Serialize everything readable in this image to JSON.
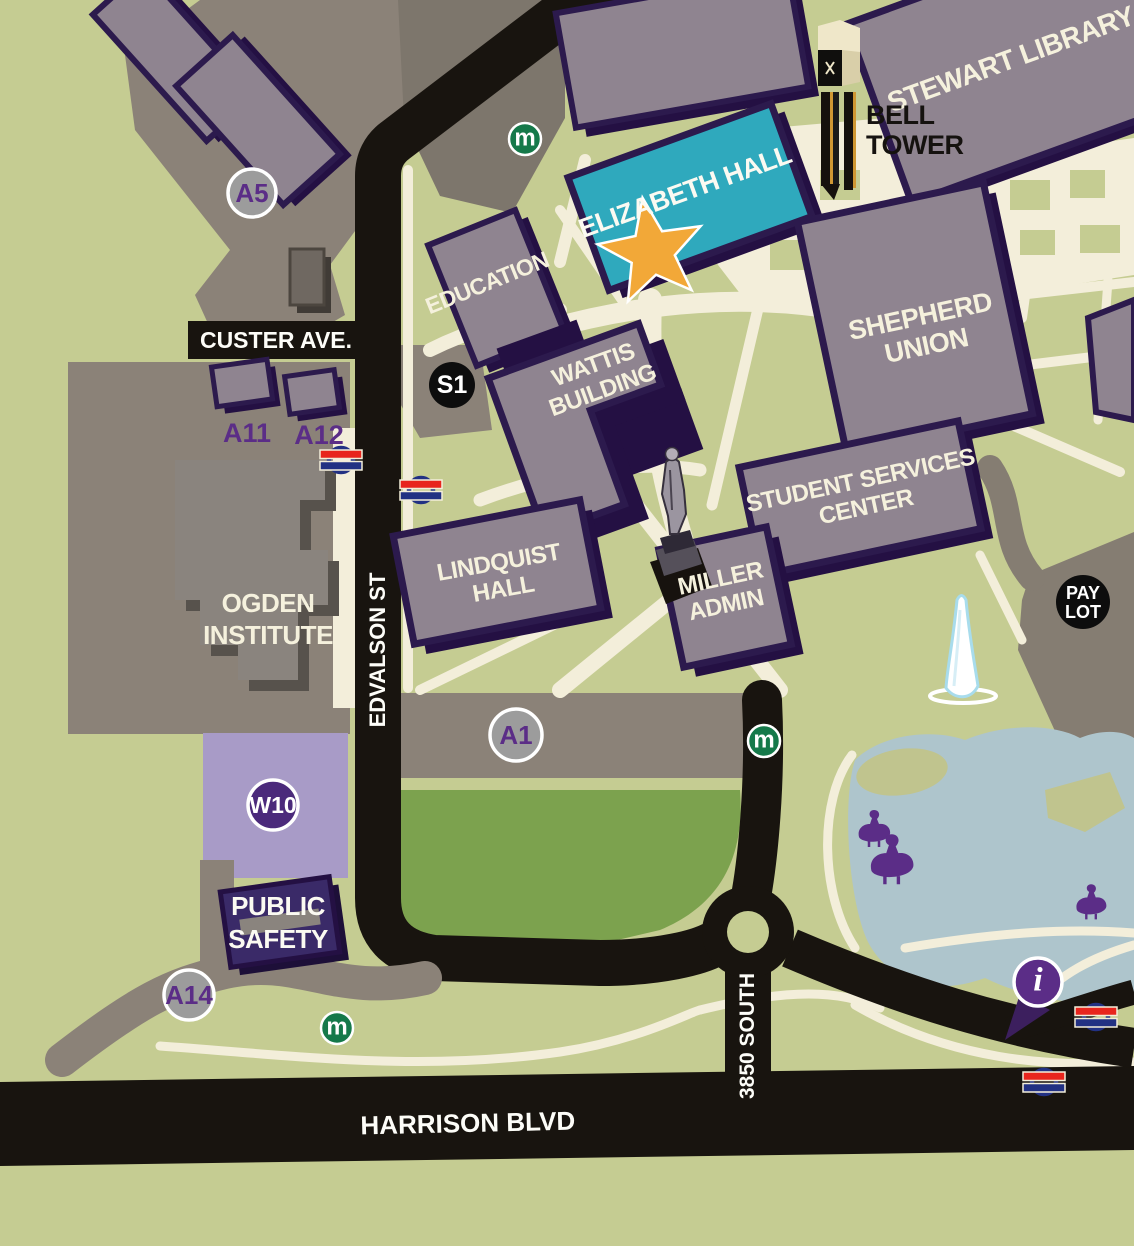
{
  "roads": {
    "custer_ave": "CUSTER AVE.",
    "edvalson_st": "EDVALSON ST",
    "south_3850": "3850 SOUTH",
    "harrison_blvd": "HARRISON BLVD"
  },
  "buildings": {
    "stewart_library": "STEWART LIBRARY",
    "elizabeth_hall": "ELIZABETH HALL",
    "education": "EDUCATION",
    "shepherd_union": {
      "line1": "SHEPHERD",
      "line2": "UNION"
    },
    "wattis_building": {
      "line1": "WATTIS",
      "line2": "BUILDING"
    },
    "student_services_center": {
      "line1": "STUDENT SERVICES",
      "line2": "CENTER"
    },
    "lindquist_hall": {
      "line1": "LINDQUIST",
      "line2": "HALL"
    },
    "miller_admin": {
      "line1": "MILLER",
      "line2": "ADMIN"
    },
    "ogden_institute": {
      "line1": "OGDEN",
      "line2": "INSTITUTE"
    },
    "public_safety": {
      "line1": "PUBLIC",
      "line2": "SAFETY"
    }
  },
  "landmarks": {
    "bell_tower": {
      "line1": "BELL",
      "line2": "TOWER"
    }
  },
  "markers": {
    "a5": "A5",
    "a11": "A11",
    "a12": "A12",
    "s1": "S1",
    "a1": "A1",
    "w10": "W10",
    "a14": "A14",
    "pay_lot": {
      "line1": "PAY",
      "line2": "LOT"
    },
    "metro": "m",
    "info": "i"
  },
  "colors": {
    "background_green": "#c5cc92",
    "field_green": "#7ca24e",
    "path_cream": "#f3eeda",
    "road_black": "#18140f",
    "building_gray": "#8f8490",
    "building_outline_purple": "#2c1a4d",
    "building_shadow_purple": "#241043",
    "elizabeth_teal": "#2fa9bd",
    "star_orange": "#f2a838",
    "parking_gray": "#8b8278",
    "w10_lot_purple": "#a89bc7",
    "accent_purple": "#5b2d87",
    "metro_green": "#15794a",
    "stop_red": "#e8251d",
    "stop_navy": "#223183",
    "pond_blue": "#aec5cc",
    "badge_gray": "#9c9c9c",
    "badge_black": "#0d0d0d"
  }
}
